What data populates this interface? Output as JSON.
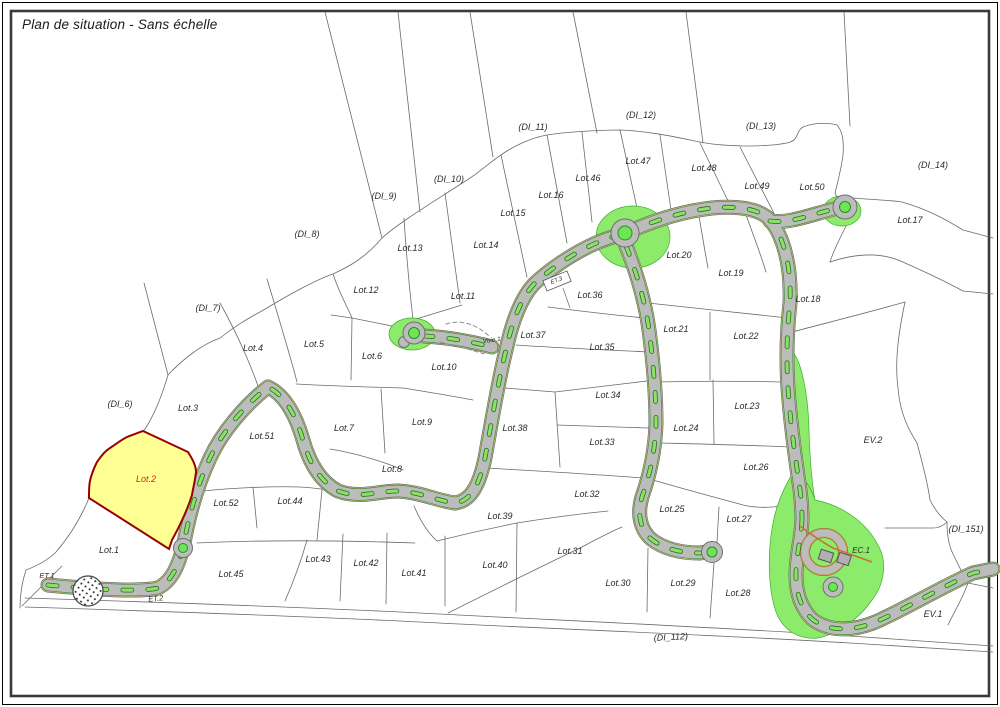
{
  "title": "Plan de situation - Sans échelle",
  "map": {
    "colors": {
      "text": "#2b2b2b",
      "parcel_line": "#6a6a6a",
      "frame": "#2e2e2e",
      "road_gray": "#bcbcbc",
      "road_outline": "#6f6f6f",
      "verge_khaki": "#d6c189",
      "verge_brown": "#8a7040",
      "marking_green": "#8ce06a",
      "marking_green_dark": "#27701c",
      "green_area": "#8ceb6a",
      "green_area_edge": "#3fae2a",
      "roundabout_center": "#6fe455",
      "lot2_fill": "#ffff94",
      "lot2_border": "#990000",
      "lot2_text": "#cc2222",
      "orange_path": "#c87137"
    },
    "labels": [
      {
        "t": "(DI_11)",
        "x": 533,
        "y": 130
      },
      {
        "t": "(DI_12)",
        "x": 641,
        "y": 118
      },
      {
        "t": "(DI_13)",
        "x": 761,
        "y": 129
      },
      {
        "t": "(DI_14)",
        "x": 933,
        "y": 168
      },
      {
        "t": "(DI_10)",
        "x": 449,
        "y": 182
      },
      {
        "t": "(DI_9)",
        "x": 384,
        "y": 199
      },
      {
        "t": "(DI_8)",
        "x": 307,
        "y": 237
      },
      {
        "t": "(DI_7)",
        "x": 208,
        "y": 311
      },
      {
        "t": "(DI_6)",
        "x": 120,
        "y": 407
      },
      {
        "t": "(DI_151)",
        "x": 966,
        "y": 532
      },
      {
        "t": "(DI_112)",
        "x": 671,
        "y": 640,
        "r": -3
      },
      {
        "t": "Lot.47",
        "x": 638,
        "y": 164
      },
      {
        "t": "Lot.46",
        "x": 588,
        "y": 181
      },
      {
        "t": "Lot.16",
        "x": 551,
        "y": 198
      },
      {
        "t": "Lot.15",
        "x": 513,
        "y": 216
      },
      {
        "t": "Lot.48",
        "x": 704,
        "y": 171
      },
      {
        "t": "Lot.49",
        "x": 757,
        "y": 189
      },
      {
        "t": "Lot.50",
        "x": 812,
        "y": 190
      },
      {
        "t": "Lot.17",
        "x": 910,
        "y": 223
      },
      {
        "t": "Lot.13",
        "x": 410,
        "y": 251
      },
      {
        "t": "Lot.14",
        "x": 486,
        "y": 248
      },
      {
        "t": "Lot.12",
        "x": 366,
        "y": 293
      },
      {
        "t": "Lot.11",
        "x": 463,
        "y": 299
      },
      {
        "t": "Lot.20",
        "x": 679,
        "y": 258
      },
      {
        "t": "Lot.19",
        "x": 731,
        "y": 276
      },
      {
        "t": "Lot.18",
        "x": 808,
        "y": 302
      },
      {
        "t": "Lot.36",
        "x": 590,
        "y": 298
      },
      {
        "t": "Lot.37",
        "x": 533,
        "y": 338
      },
      {
        "t": "Lot.35",
        "x": 602,
        "y": 350
      },
      {
        "t": "Lot.21",
        "x": 676,
        "y": 332
      },
      {
        "t": "Lot.22",
        "x": 746,
        "y": 339
      },
      {
        "t": "Lot.4",
        "x": 253,
        "y": 351
      },
      {
        "t": "Lot.5",
        "x": 314,
        "y": 347
      },
      {
        "t": "Lot.6",
        "x": 372,
        "y": 359
      },
      {
        "t": "Lot.3",
        "x": 188,
        "y": 411
      },
      {
        "t": "Lot.10",
        "x": 444,
        "y": 370
      },
      {
        "t": "Lot.34",
        "x": 608,
        "y": 398
      },
      {
        "t": "Lot.23",
        "x": 747,
        "y": 409
      },
      {
        "t": "Lot.7",
        "x": 344,
        "y": 431
      },
      {
        "t": "Lot.9",
        "x": 422,
        "y": 425
      },
      {
        "t": "Lot.38",
        "x": 515,
        "y": 431
      },
      {
        "t": "Lot.33",
        "x": 602,
        "y": 445
      },
      {
        "t": "Lot.24",
        "x": 686,
        "y": 431
      },
      {
        "t": "Lot.51",
        "x": 262,
        "y": 439
      },
      {
        "t": "EV.2",
        "x": 873,
        "y": 443
      },
      {
        "t": "Lot.2",
        "x": 146,
        "y": 482,
        "c": "#cc2222"
      },
      {
        "t": "Lot.8",
        "x": 392,
        "y": 472
      },
      {
        "t": "Lot.26",
        "x": 756,
        "y": 470
      },
      {
        "t": "Lot.32",
        "x": 587,
        "y": 497
      },
      {
        "t": "Lot.25",
        "x": 672,
        "y": 512
      },
      {
        "t": "Lot.52",
        "x": 226,
        "y": 506
      },
      {
        "t": "Lot.44",
        "x": 290,
        "y": 504
      },
      {
        "t": "Lot.39",
        "x": 500,
        "y": 519
      },
      {
        "t": "Lot.27",
        "x": 739,
        "y": 522
      },
      {
        "t": "Lot.1",
        "x": 109,
        "y": 553
      },
      {
        "t": "Lot.45",
        "x": 231,
        "y": 577
      },
      {
        "t": "Lot.43",
        "x": 318,
        "y": 562
      },
      {
        "t": "Lot.42",
        "x": 366,
        "y": 566
      },
      {
        "t": "Lot.41",
        "x": 414,
        "y": 576
      },
      {
        "t": "Lot.40",
        "x": 495,
        "y": 568
      },
      {
        "t": "Lot.31",
        "x": 570,
        "y": 554
      },
      {
        "t": "Lot.30",
        "x": 618,
        "y": 586
      },
      {
        "t": "Lot.29",
        "x": 683,
        "y": 586
      },
      {
        "t": "Lot.28",
        "x": 738,
        "y": 596
      },
      {
        "t": "EC.1",
        "x": 861,
        "y": 553,
        "s": 8
      },
      {
        "t": "EV.1",
        "x": 933,
        "y": 617
      },
      {
        "t": "ET.1",
        "x": 47,
        "y": 578,
        "s": 7.5
      },
      {
        "t": "ET.2",
        "x": 156,
        "y": 601,
        "s": 7.5,
        "r": -6
      },
      {
        "t": "Voie.1",
        "x": 492,
        "y": 342,
        "s": 6.5,
        "r": -8
      },
      {
        "t": "ET.3",
        "x": 557,
        "y": 282,
        "s": 6,
        "r": -22
      }
    ]
  }
}
